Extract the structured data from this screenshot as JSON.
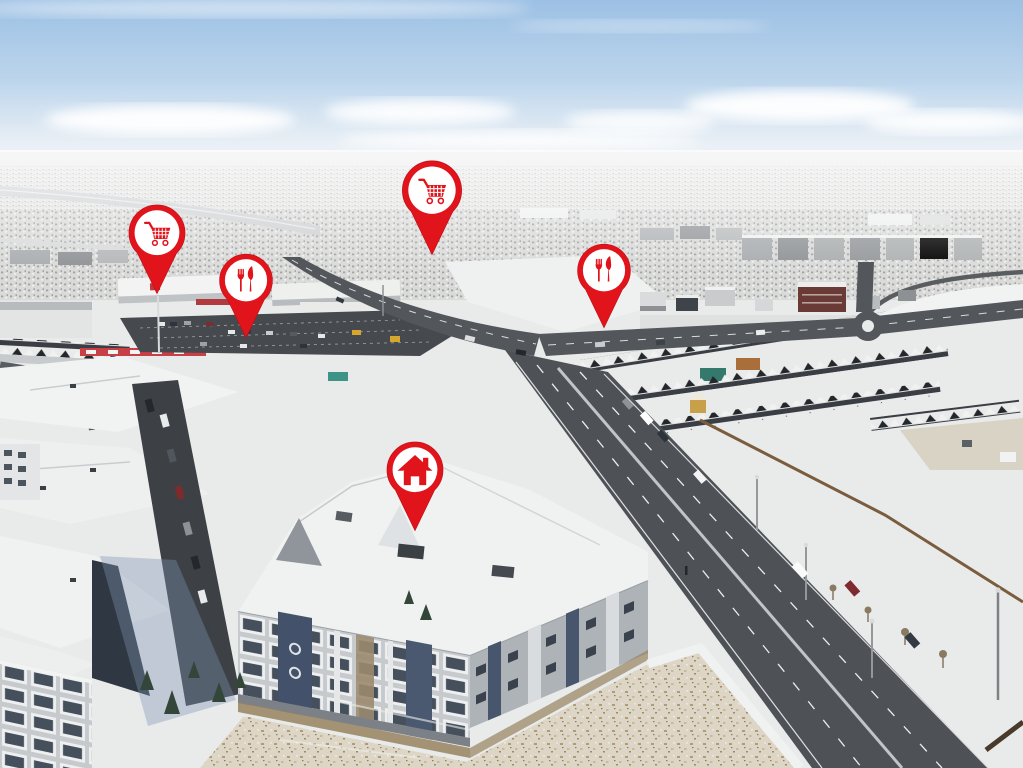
{
  "meta": {
    "type": "aerial-real-estate-photo",
    "description": "Winter aerial drone photo of a snowy suburban neighbourhood. Red map pins overlay the photo marking two grocery stores, two restaurants and the featured home. A commercial plaza sits upper-left, a large arterial road runs diagonally to the bottom-right past townhouse rows, snow-covered condo buildings fill the foreground and a snowy grass field occupies the bottom-right.",
    "season": "winter",
    "sky": "blue with low white clouds on the horizon"
  },
  "palette": {
    "pin_red": "#e1141c",
    "pin_white": "#ffffff",
    "sky_top": "#9cc0e4",
    "sky_horizon": "#f4f7f9",
    "snow": "#e9ebea",
    "asphalt": "#515459",
    "winter_grass": "#ddd6c6",
    "roof_dark": "#3a3e44"
  },
  "markers": [
    {
      "id": "grocery-west",
      "label": "Grocery store",
      "icon": "shopping-cart-icon",
      "tip_x": 157,
      "tip_y": 295,
      "style": "left:15.35%;top:38.40%;width:70px"
    },
    {
      "id": "grocery-north",
      "label": "Grocery store",
      "icon": "shopping-cart-icon",
      "tip_x": 432,
      "tip_y": 256,
      "style": "left:42.20%;top:33.33%;width:74px"
    },
    {
      "id": "restaurant-west",
      "label": "Restaurant",
      "icon": "utensils-icon",
      "tip_x": 246,
      "tip_y": 339,
      "style": "left:24.05%;top:44.15%;width:66px"
    },
    {
      "id": "restaurant-east",
      "label": "Restaurant",
      "icon": "utensils-icon",
      "tip_x": 604,
      "tip_y": 329,
      "style": "left:59.00%;top:42.85%;width:66px"
    },
    {
      "id": "home-property",
      "label": "Home",
      "icon": "home-icon",
      "tip_x": 415,
      "tip_y": 532,
      "style": "left:40.55%;top:69.27%;width:70px"
    }
  ]
}
